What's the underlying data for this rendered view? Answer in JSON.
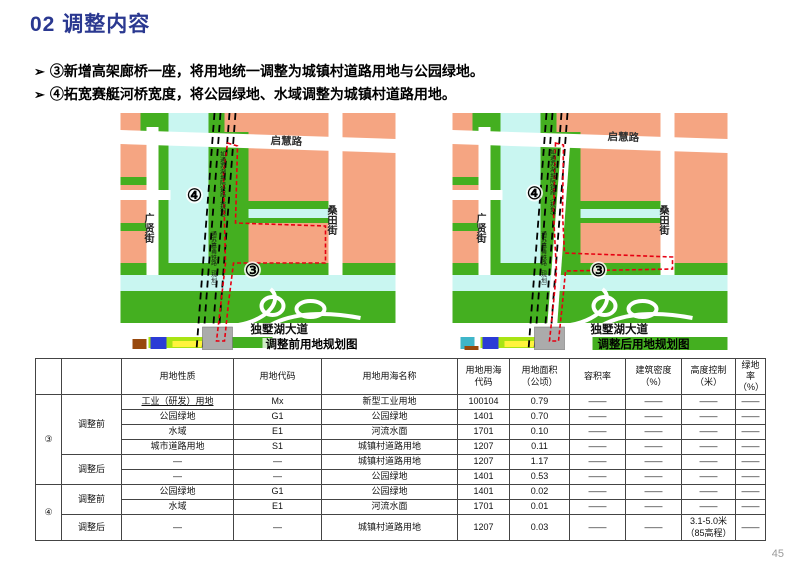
{
  "slide": {
    "title": "02 调整内容",
    "bullet_marker": "➢",
    "bullets": [
      "③新增高架廊桥一座，将用地统一调整为城镇村道路用地与公园绿地。",
      "④拓宽赛艇河桥宽度，将公园绿地、水域调整为城镇村道路用地。"
    ],
    "page_number": "45"
  },
  "maps": {
    "left": {
      "caption": "调整前用地规划图",
      "roads": {
        "top": "启慧路",
        "left": "广贤街",
        "right": "桑田街",
        "bottom": "独墅湖大道"
      },
      "rails": [
        "如通苏湖城际铁路（规划）",
        "通苏嘉甬铁路（规划）"
      ],
      "markers": {
        "m4": "④",
        "m3": "③"
      }
    },
    "right": {
      "caption": "调整后用地规划图",
      "roads": {
        "top": "启慧路",
        "left": "广贤街",
        "right": "桑田街",
        "bottom": "独墅湖大道"
      },
      "rails": [
        "如通苏湖城际铁路（规划）",
        "通苏嘉甬铁路（规划）"
      ],
      "markers": {
        "m4": "④",
        "m3": "③"
      }
    }
  },
  "table": {
    "headers": {
      "prop": "用地性质",
      "code": "用地代码",
      "sea_name": "用地用海名称",
      "sea_code": "用地用海\n代码",
      "area": "用地面积\n（公顷）",
      "far": "容积率",
      "density": "建筑密度\n（%）",
      "height": "高度控制\n（米）",
      "green": "绿地率\n（%）"
    },
    "groups": [
      {
        "label": "③"
      },
      {
        "label": "④"
      }
    ],
    "phases": [
      "调整前",
      "调整后",
      "调整前",
      "调整后"
    ],
    "rows": [
      {
        "cells": [
          "工业（研发）用地",
          "Mx",
          "新型工业用地",
          "100104",
          "0.79",
          "——",
          "——",
          "——",
          "——"
        ]
      },
      {
        "cells": [
          "公园绿地",
          "G1",
          "公园绿地",
          "1401",
          "0.70",
          "——",
          "——",
          "——",
          "——"
        ]
      },
      {
        "cells": [
          "水域",
          "E1",
          "河流水面",
          "1701",
          "0.10",
          "——",
          "——",
          "——",
          "——"
        ]
      },
      {
        "cells": [
          "城市道路用地",
          "S1",
          "城镇村道路用地",
          "1207",
          "0.11",
          "——",
          "——",
          "——",
          "——"
        ]
      },
      {
        "cells": [
          "—",
          "—",
          "城镇村道路用地",
          "1207",
          "1.17",
          "——",
          "——",
          "——",
          "——"
        ]
      },
      {
        "cells": [
          "—",
          "—",
          "公园绿地",
          "1401",
          "0.53",
          "——",
          "——",
          "——",
          "——"
        ]
      },
      {
        "cells": [
          "公园绿地",
          "G1",
          "公园绿地",
          "1401",
          "0.02",
          "——",
          "——",
          "——",
          "——"
        ]
      },
      {
        "cells": [
          "水域",
          "E1",
          "河流水面",
          "1701",
          "0.01",
          "——",
          "——",
          "——",
          "——"
        ]
      },
      {
        "cells": [
          "—",
          "—",
          "城镇村道路用地",
          "1207",
          "0.03",
          "——",
          "——",
          "3.1-5.0米\n（85高程）",
          "——"
        ]
      }
    ]
  },
  "colors": {
    "title_blue": "#2A3890",
    "salmon": "#F5A582",
    "green": "#44AF20",
    "water_cyan": "#C9F6F1",
    "chartreuse": "#A8E413",
    "yellow": "#FFF33C",
    "blue_block": "#2B3BD6",
    "brown": "#98490E",
    "gray_station": "#ABABAB",
    "red_boundary": "#E60012"
  }
}
